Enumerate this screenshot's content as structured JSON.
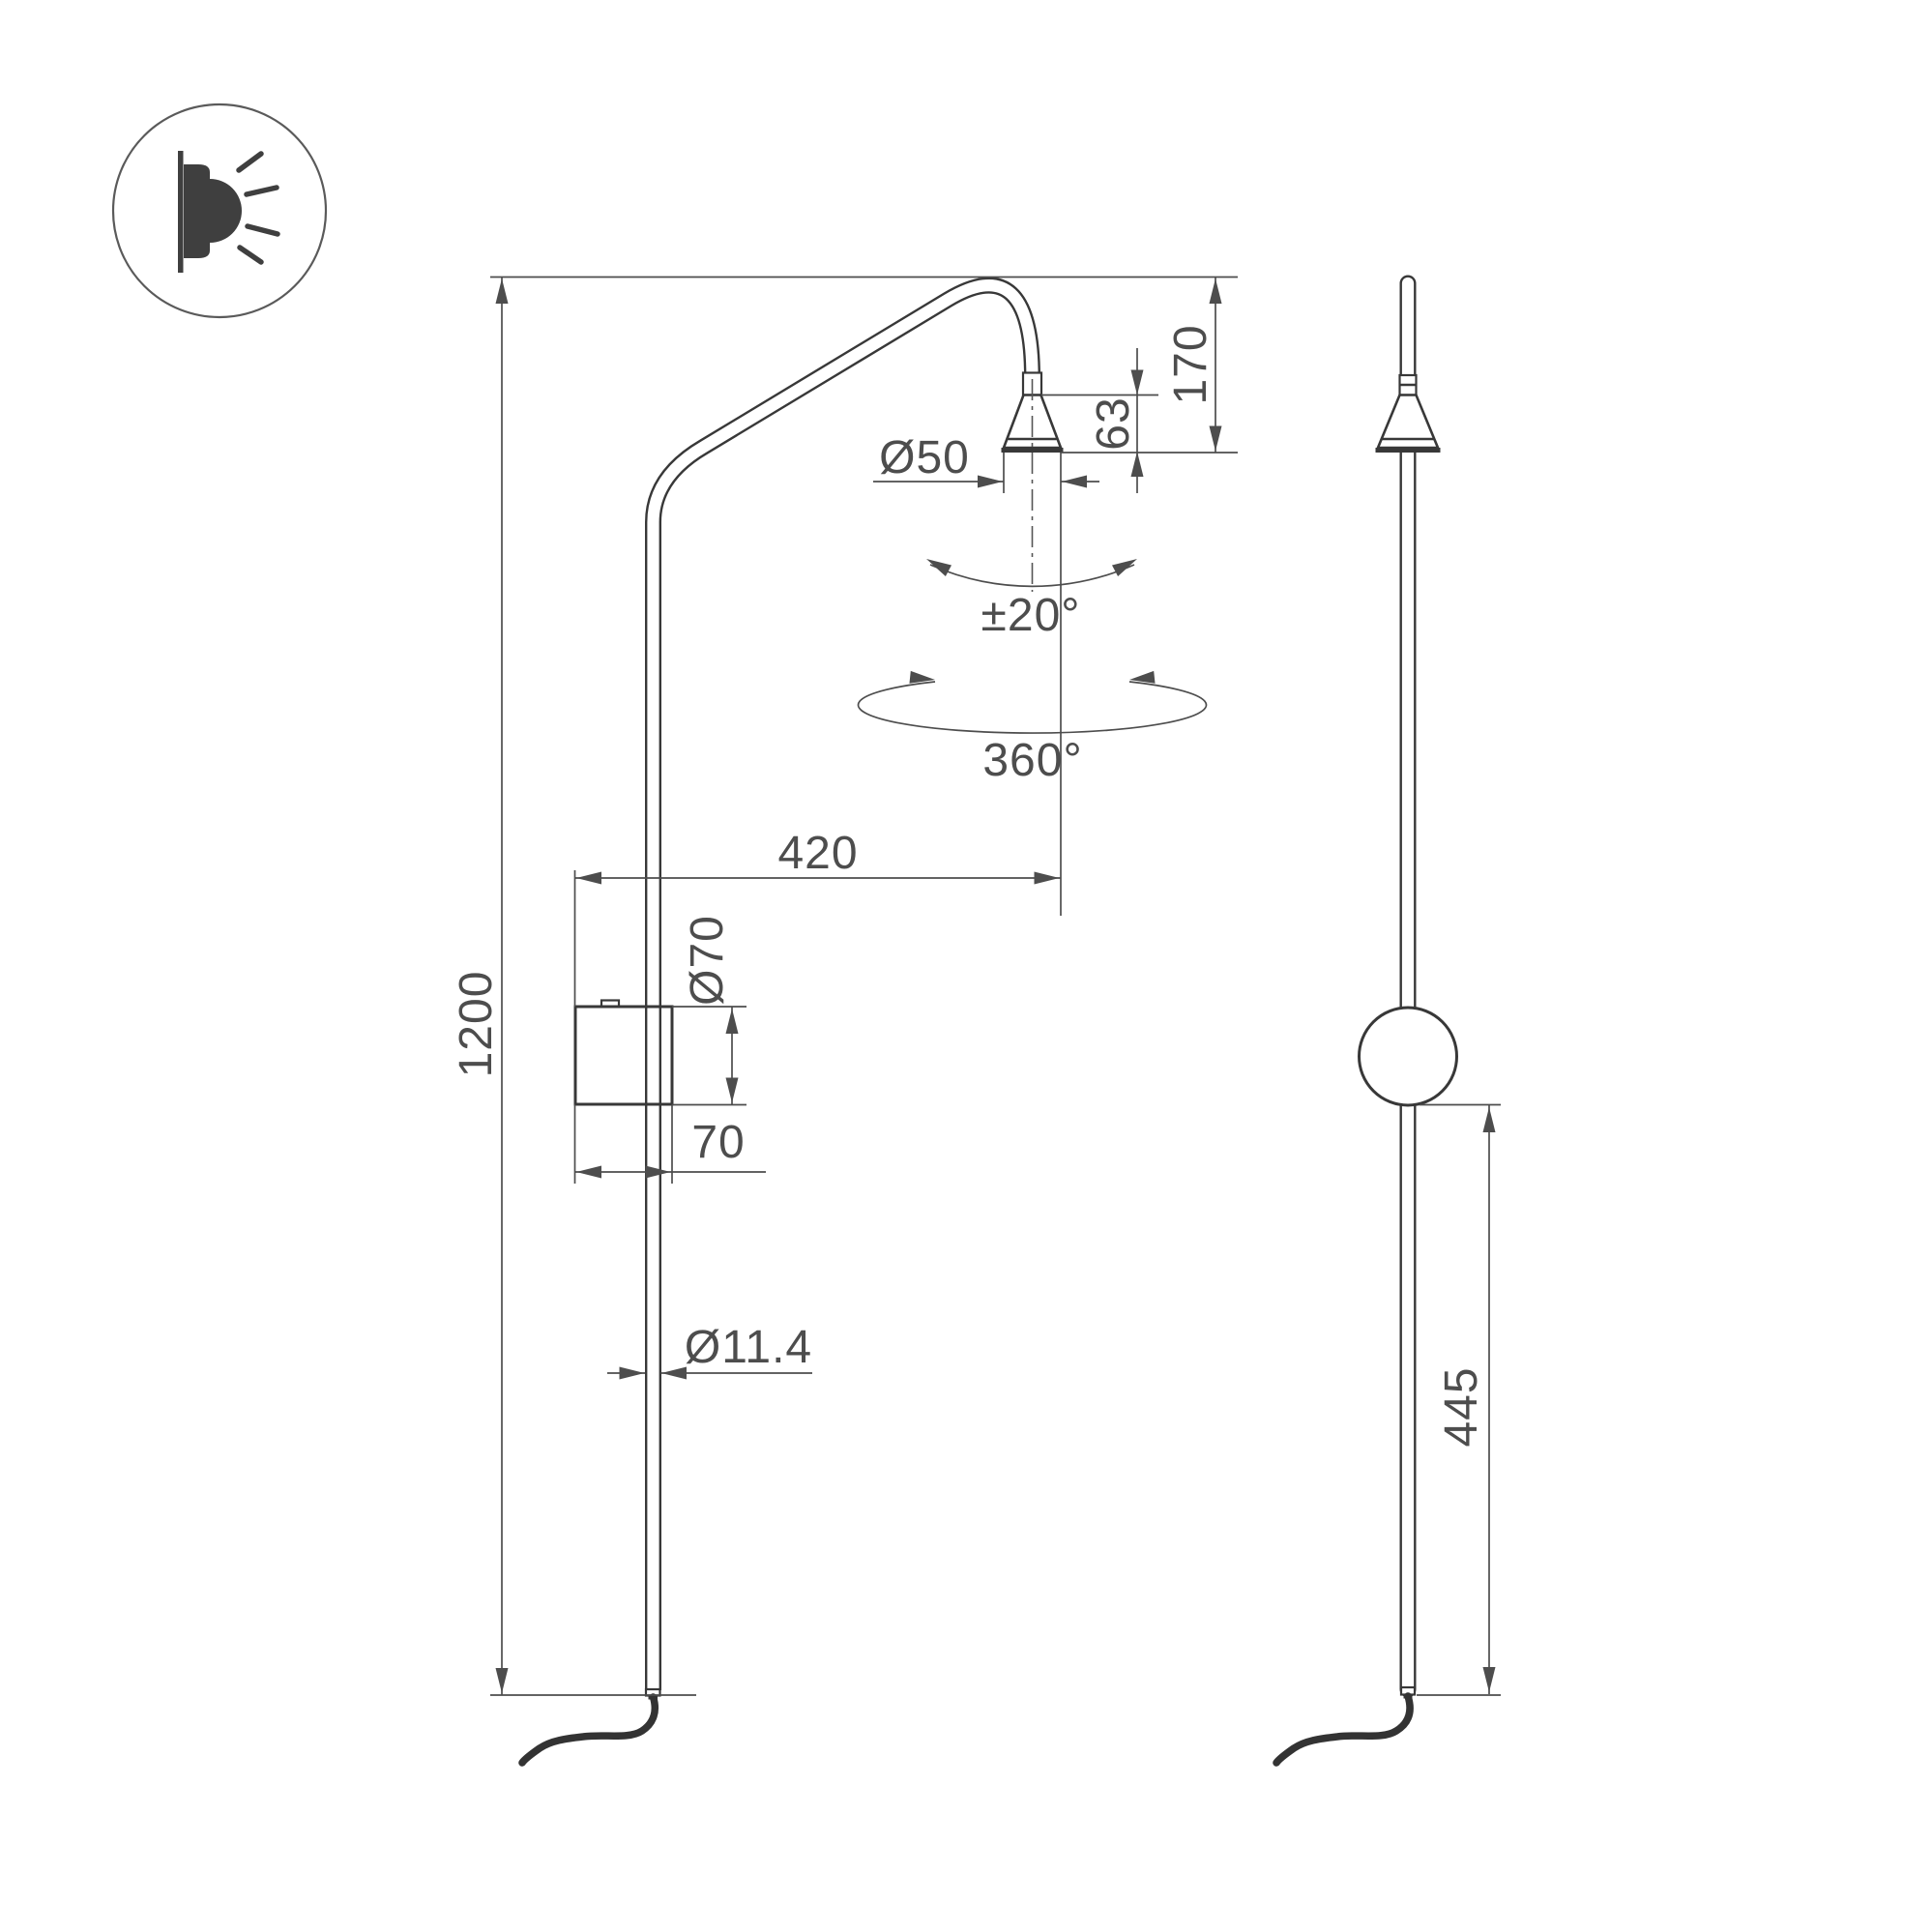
{
  "page": {
    "background": "#ffffff",
    "type": "technical-drawing"
  },
  "logo": {
    "icon": "wall-light-icon"
  },
  "views": {
    "front": {
      "name": "front-view",
      "dimensions": {
        "overall_height": "1200",
        "arm_reach": "420",
        "head_offset_height": "170",
        "head_cone_height": "63",
        "head_diameter": "Ø50",
        "tilt_angle": "±20°",
        "rotation_angle": "360°",
        "canopy_diameter": "Ø70",
        "canopy_depth": "70",
        "tube_diameter": "Ø11.4"
      }
    },
    "side": {
      "name": "side-view",
      "dimensions": {
        "canopy_to_tube_end": "445"
      }
    }
  },
  "colors": {
    "object_line": "#383838",
    "dimension_line": "#4d4d4d",
    "text": "#4d4d4d",
    "background": "#ffffff"
  }
}
